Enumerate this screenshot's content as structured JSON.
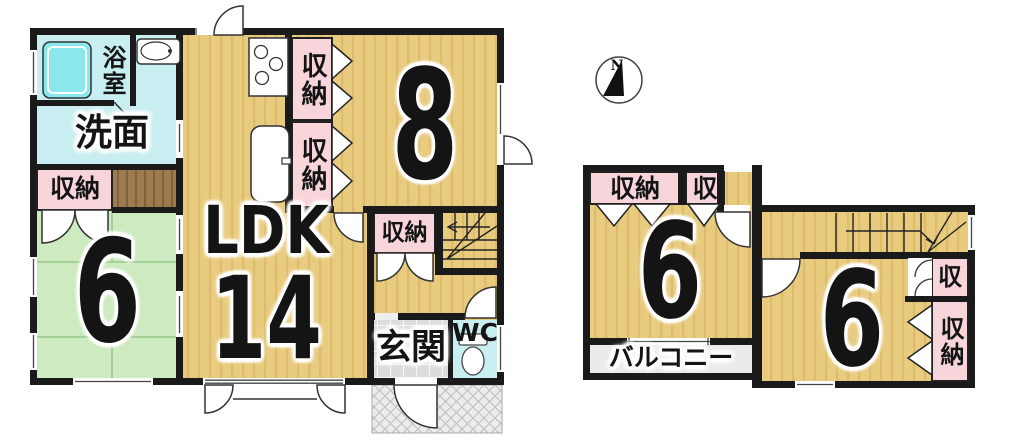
{
  "colors": {
    "wall": "#1a1a1a",
    "tatami_tan": "#e9cb80",
    "tan_stripe": "#dcbc6a",
    "storage_pink": "#f7d5da",
    "water_cyan": "#c9eef1",
    "bathtub_cyan": "#8ae8ec",
    "tatami_green": "#cdeac0",
    "wood_brown": "#9c7b4f",
    "entrance_tile": "#dcdcdc",
    "porch_gray": "#ececec",
    "balcony_gray": "#ebebeb"
  },
  "compass": {
    "north_label": "N"
  },
  "first_floor": {
    "bath_label": "浴室",
    "washroom_label": "洗面",
    "storage_left_label": "収納",
    "tatami_room_size": "6",
    "ldk_label": "LDK",
    "ldk_size": "14",
    "kitchen_storage_top_label": "収納",
    "kitchen_storage_bottom_label": "収納",
    "bedroom_size": "8",
    "hall_storage_label": "収納",
    "entrance_label": "玄関",
    "wc_label": "WC"
  },
  "second_floor": {
    "storage_a_label": "収納",
    "storage_b_label": "収",
    "room_left_size": "6",
    "balcony_label": "バルコニー",
    "room_right_size": "6",
    "storage_c_label": "収",
    "storage_d_label": "収納"
  }
}
